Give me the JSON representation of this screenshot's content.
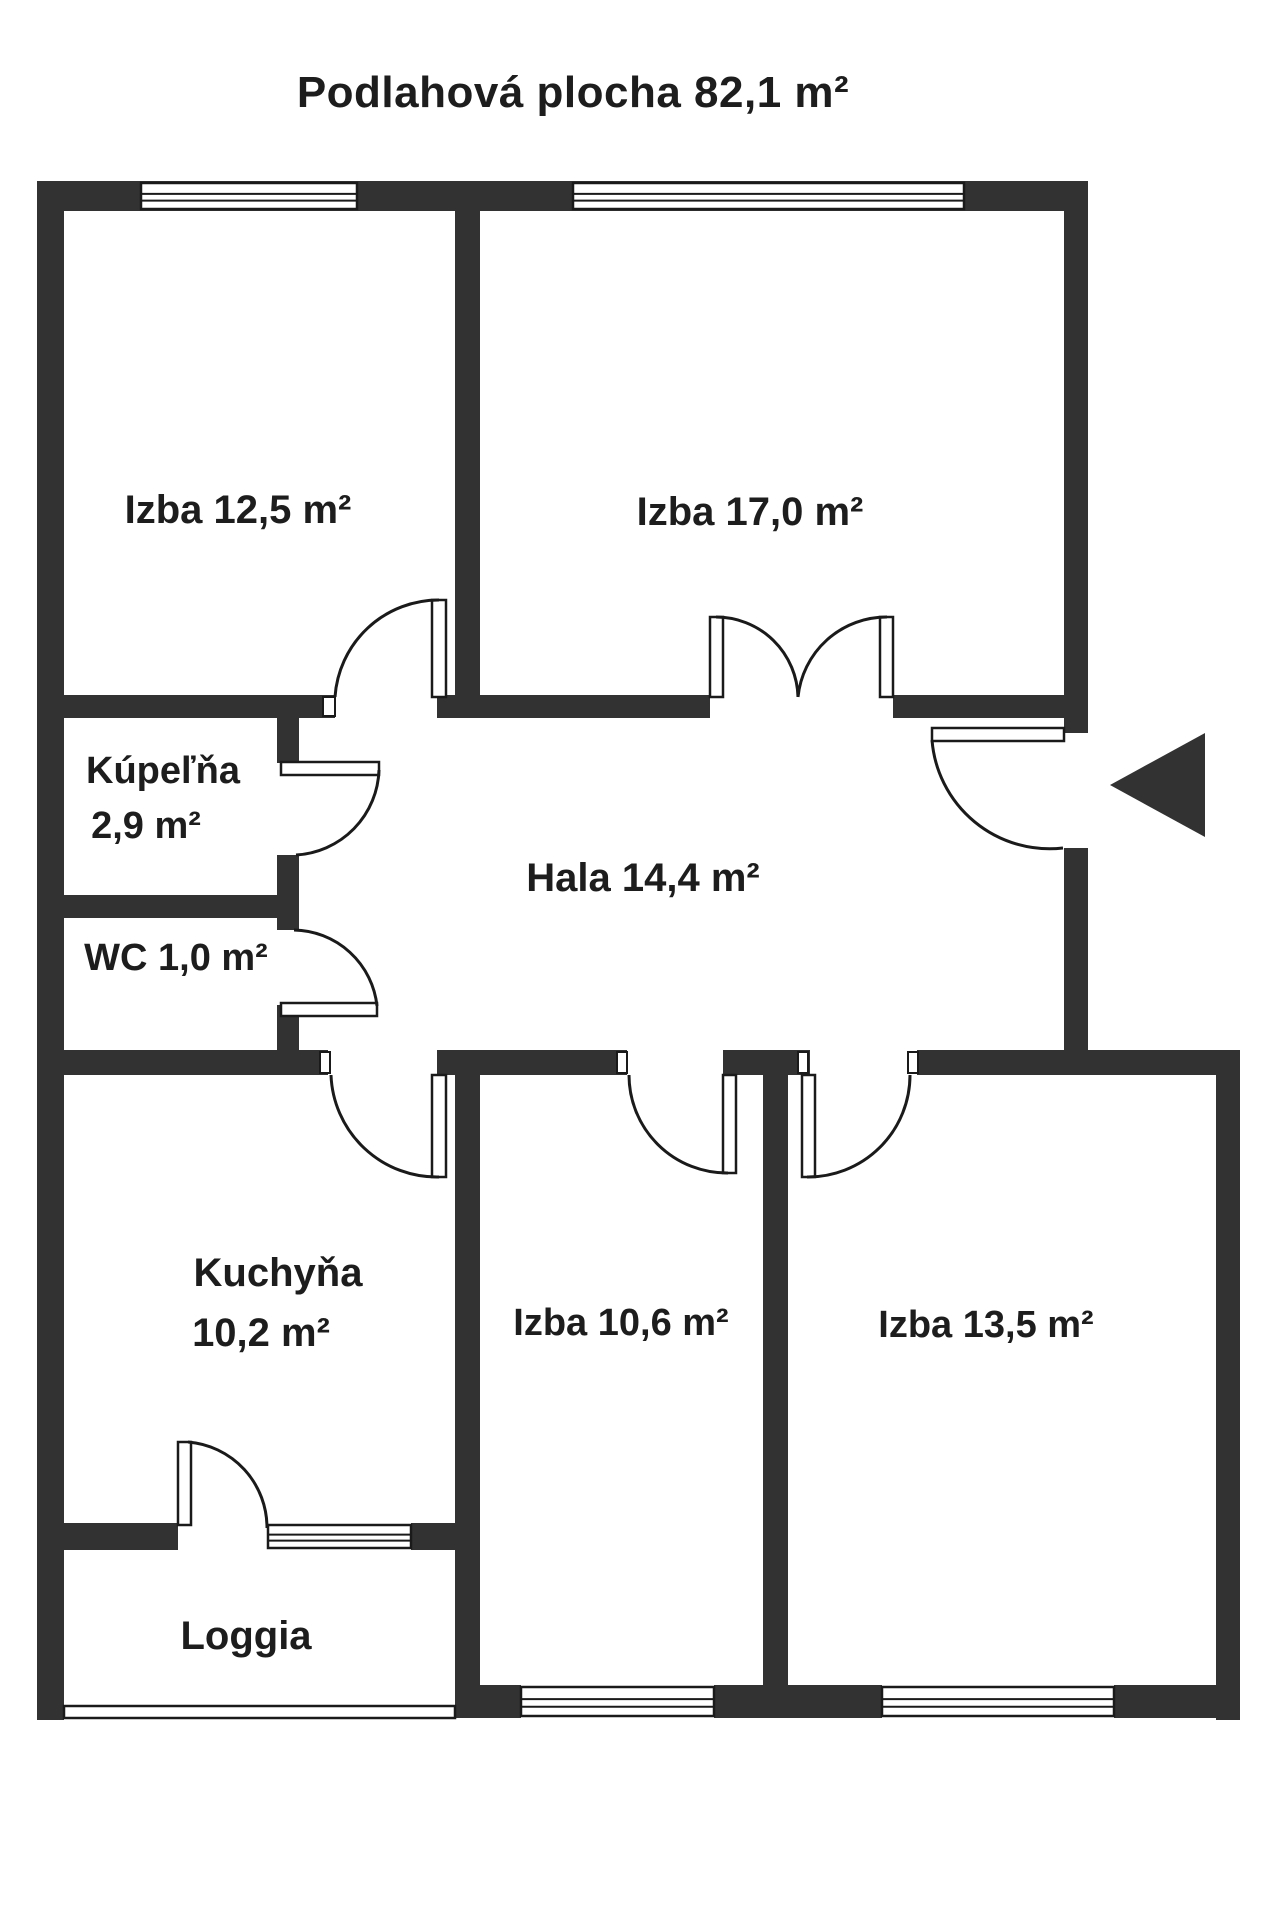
{
  "title": {
    "text": "Podlahová plocha 82,1 m²"
  },
  "canvas": {
    "width": 1280,
    "height": 1920
  },
  "colors": {
    "background": "#ffffff",
    "wall": "#323232",
    "line": "#1a1a1a",
    "text": "#1d1d1d"
  },
  "floor_plan": {
    "total_area_label": "Podlahová plocha 82,1 m²",
    "rooms": [
      {
        "id": "izba-12-5",
        "name": "Izba",
        "area": "12,5 m²",
        "lines": [
          {
            "text": "Izba 12,5 m²",
            "cx": 238,
            "cy": 510,
            "size": 40
          }
        ]
      },
      {
        "id": "izba-17-0",
        "name": "Izba",
        "area": "17,0 m²",
        "lines": [
          {
            "text": "Izba 17,0 m²",
            "cx": 750,
            "cy": 512,
            "size": 40
          }
        ]
      },
      {
        "id": "kupelna",
        "name": "Kúpeľňa",
        "area": "2,9 m²",
        "lines": [
          {
            "text": "Kúpeľňa",
            "cx": 163,
            "cy": 771,
            "size": 38
          },
          {
            "text": "2,9 m²",
            "cx": 146,
            "cy": 826,
            "size": 38
          }
        ]
      },
      {
        "id": "wc",
        "name": "WC",
        "area": "1,0 m²",
        "lines": [
          {
            "text": "WC 1,0 m²",
            "cx": 176,
            "cy": 958,
            "size": 38
          }
        ]
      },
      {
        "id": "hala",
        "name": "Hala",
        "area": "14,4 m²",
        "lines": [
          {
            "text": "Hala 14,4 m²",
            "cx": 643,
            "cy": 878,
            "size": 40
          }
        ]
      },
      {
        "id": "kuchyna",
        "name": "Kuchyňa",
        "area": "10,2 m²",
        "lines": [
          {
            "text": "Kuchyňa",
            "cx": 278,
            "cy": 1273,
            "size": 40
          },
          {
            "text": "10,2 m²",
            "cx": 261,
            "cy": 1333,
            "size": 40
          }
        ]
      },
      {
        "id": "izba-10-6",
        "name": "Izba",
        "area": "10,6 m²",
        "lines": [
          {
            "text": "Izba 10,6 m²",
            "cx": 621,
            "cy": 1323,
            "size": 38
          }
        ]
      },
      {
        "id": "izba-13-5",
        "name": "Izba",
        "area": "13,5 m²",
        "lines": [
          {
            "text": "Izba 13,5 m²",
            "cx": 986,
            "cy": 1325,
            "size": 38
          }
        ]
      },
      {
        "id": "loggia",
        "name": "Loggia",
        "area": "",
        "lines": [
          {
            "text": "Loggia",
            "cx": 246,
            "cy": 1636,
            "size": 40
          }
        ]
      }
    ],
    "walls": [
      {
        "name": "wall-outer-top",
        "x": 37,
        "y": 181,
        "w": 1051,
        "h": 30
      },
      {
        "name": "wall-outer-left",
        "x": 37,
        "y": 181,
        "w": 27,
        "h": 1539
      },
      {
        "name": "wall-outer-right-upper",
        "x": 1064,
        "y": 181,
        "w": 24,
        "h": 552
      },
      {
        "name": "wall-outer-right-mid",
        "x": 1064,
        "y": 848,
        "w": 24,
        "h": 224
      },
      {
        "name": "wall-outer-right-lower",
        "x": 1216,
        "y": 1050,
        "w": 24,
        "h": 670
      },
      {
        "name": "wall-divider-top-rooms",
        "x": 455,
        "y": 205,
        "w": 25,
        "h": 513
      },
      {
        "name": "wall-izba125-bottom-left",
        "x": 64,
        "y": 695,
        "w": 271,
        "h": 23
      },
      {
        "name": "wall-izba125-bottom-right",
        "x": 437,
        "y": 695,
        "w": 43,
        "h": 23
      },
      {
        "name": "wall-izba17-bottom-left",
        "x": 480,
        "y": 695,
        "w": 230,
        "h": 23
      },
      {
        "name": "wall-izba17-bottom-right",
        "x": 893,
        "y": 695,
        "w": 195,
        "h": 23
      },
      {
        "name": "wall-kupelna-right-a",
        "x": 277,
        "y": 695,
        "w": 22,
        "h": 68
      },
      {
        "name": "wall-kupelna-right-b",
        "x": 277,
        "y": 855,
        "w": 22,
        "h": 75
      },
      {
        "name": "wall-wc-right",
        "x": 277,
        "y": 1005,
        "w": 22,
        "h": 67
      },
      {
        "name": "wall-kupelna-wc-divider",
        "x": 64,
        "y": 895,
        "w": 235,
        "h": 23
      },
      {
        "name": "wall-hala-bottom-a",
        "x": 64,
        "y": 1050,
        "w": 264,
        "h": 25
      },
      {
        "name": "wall-hala-bottom-b",
        "x": 437,
        "y": 1050,
        "w": 190,
        "h": 25
      },
      {
        "name": "wall-hala-bottom-c",
        "x": 723,
        "y": 1050,
        "w": 87,
        "h": 25
      },
      {
        "name": "wall-hala-bottom-d",
        "x": 917,
        "y": 1050,
        "w": 323,
        "h": 25
      },
      {
        "name": "wall-kuchyna-divider",
        "x": 455,
        "y": 1072,
        "w": 25,
        "h": 646
      },
      {
        "name": "wall-izba-divider",
        "x": 763,
        "y": 1072,
        "w": 25,
        "h": 613
      },
      {
        "name": "wall-loggia-top-left",
        "x": 64,
        "y": 1523,
        "w": 114,
        "h": 27
      },
      {
        "name": "wall-loggia-top-right",
        "x": 411,
        "y": 1523,
        "w": 44,
        "h": 27
      },
      {
        "name": "wall-bottom-a",
        "x": 455,
        "y": 1685,
        "w": 66,
        "h": 33
      },
      {
        "name": "wall-bottom-b",
        "x": 714,
        "y": 1685,
        "w": 168,
        "h": 33
      },
      {
        "name": "wall-bottom-c",
        "x": 1114,
        "y": 1685,
        "w": 126,
        "h": 33
      }
    ],
    "windows": [
      {
        "name": "window-izba125-top",
        "x": 141,
        "y": 183,
        "w": 216,
        "h": 26
      },
      {
        "name": "window-izba17-top",
        "x": 573,
        "y": 183,
        "w": 391,
        "h": 26
      },
      {
        "name": "window-kuchyna-loggia",
        "x": 268,
        "y": 1525,
        "w": 143,
        "h": 23
      },
      {
        "name": "window-izba106-bottom",
        "x": 521,
        "y": 1687,
        "w": 193,
        "h": 29
      },
      {
        "name": "window-izba135-bottom",
        "x": 882,
        "y": 1687,
        "w": 232,
        "h": 29
      }
    ],
    "loggia_rail": {
      "name": "loggia-rail",
      "x": 64,
      "y": 1706,
      "w": 391,
      "h": 12
    },
    "door_leaves": [
      {
        "name": "door-leaf-izba125",
        "x": 432,
        "y": 600,
        "w": 14,
        "h": 97
      },
      {
        "name": "door-leaf-double-left",
        "x": 710,
        "y": 617,
        "w": 13,
        "h": 80
      },
      {
        "name": "door-leaf-double-right",
        "x": 880,
        "y": 617,
        "w": 13,
        "h": 80
      },
      {
        "name": "door-leaf-kupelna",
        "x": 281,
        "y": 762,
        "w": 98,
        "h": 13
      },
      {
        "name": "door-leaf-wc",
        "x": 281,
        "y": 1003,
        "w": 96,
        "h": 13
      },
      {
        "name": "door-leaf-kuchyna",
        "x": 432,
        "y": 1075,
        "w": 14,
        "h": 102
      },
      {
        "name": "door-leaf-izba106",
        "x": 723,
        "y": 1075,
        "w": 13,
        "h": 98
      },
      {
        "name": "door-leaf-izba135",
        "x": 802,
        "y": 1075,
        "w": 13,
        "h": 102
      },
      {
        "name": "door-leaf-entry",
        "x": 932,
        "y": 728,
        "w": 132,
        "h": 13
      },
      {
        "name": "door-leaf-loggia",
        "x": 178,
        "y": 1442,
        "w": 13,
        "h": 83
      }
    ],
    "door_arcs": [
      {
        "name": "door-arc-izba125",
        "d": "M439,600 A104,104 0 0 0 335,697"
      },
      {
        "name": "door-arc-double-left",
        "d": "M716,617 A82,82 0 0 1 798,697"
      },
      {
        "name": "door-arc-double-right",
        "d": "M887,617 A89,89 0 0 0 798,697"
      },
      {
        "name": "door-arc-kupelna",
        "d": "M379,770 A88,88 0 0 1 296,855"
      },
      {
        "name": "door-arc-wc",
        "d": "M377,1006 A85,85 0 0 0 294,930"
      },
      {
        "name": "door-arc-kuchyna",
        "d": "M439,1177 A106,106 0 0 1 331,1075"
      },
      {
        "name": "door-arc-izba106",
        "d": "M728,1173 A98,98 0 0 1 629,1075"
      },
      {
        "name": "door-arc-izba135",
        "d": "M807,1177 A102,102 0 0 0 910,1075"
      },
      {
        "name": "door-arc-entry",
        "d": "M932,740 A118,118 0 0 0 1063,848"
      },
      {
        "name": "door-arc-loggia",
        "d": "M188,1442 A86,86 0 0 1 267,1528"
      }
    ],
    "jambs": [
      {
        "name": "door-jamb-izba125",
        "x": 323,
        "y": 697,
        "w": 12,
        "h": 19
      },
      {
        "name": "door-jamb-kuchyna",
        "x": 320,
        "y": 1052,
        "w": 10,
        "h": 21
      },
      {
        "name": "door-jamb-izba106",
        "x": 617,
        "y": 1052,
        "w": 10,
        "h": 21
      },
      {
        "name": "door-jamb-izba135-l",
        "x": 798,
        "y": 1052,
        "w": 10,
        "h": 21
      },
      {
        "name": "door-jamb-izba135-r",
        "x": 908,
        "y": 1052,
        "w": 10,
        "h": 21
      }
    ],
    "entrance_arrow": {
      "name": "entrance-arrow-icon",
      "points": "1205,733 1205,837 1110,785"
    }
  }
}
